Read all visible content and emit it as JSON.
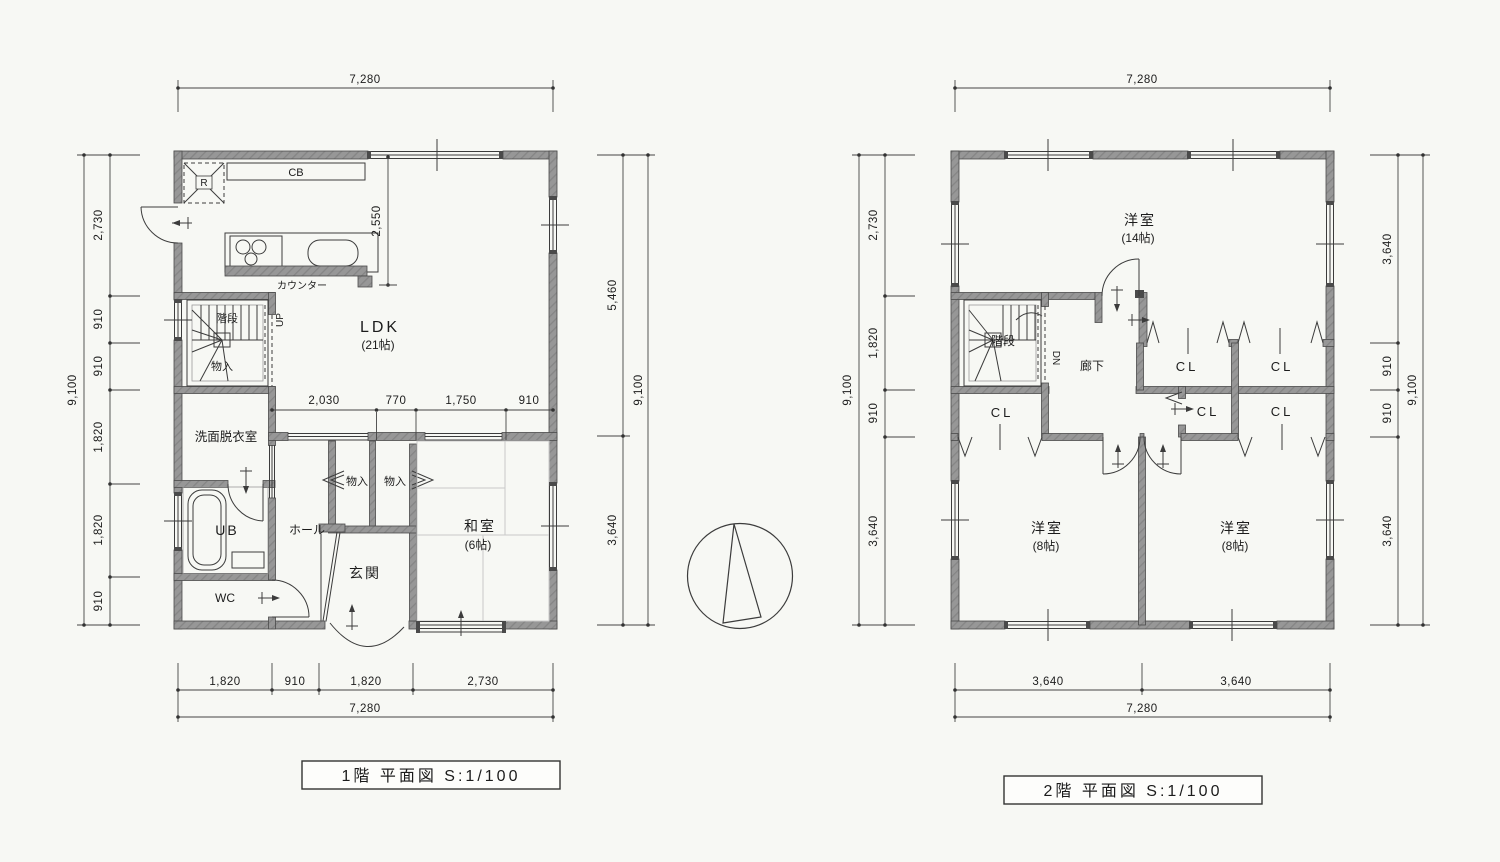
{
  "colors": {
    "background": "#f7f8f4",
    "wall": "#979797",
    "line": "#3c3c3c",
    "dimension": "#444444",
    "tatami": "#c9c9c9"
  },
  "floor1": {
    "title": "1階  平面図 S:1/100",
    "labels": {
      "ldk": "LDK",
      "ldk_size": "(21帖)",
      "washitsu": "和室",
      "washitsu_size": "(6帖)",
      "genkan": "玄関",
      "hall": "ホール",
      "wc": "WC",
      "ub": "UB",
      "senmen": "洗面脱衣室",
      "stairs": "階段",
      "stair_storage": "物入",
      "closet_left": "物入",
      "closet_right": "物入",
      "counter": "カウンター",
      "cb": "CB",
      "fridge": "R",
      "up": "UP"
    },
    "dims": {
      "top_total": "7,280",
      "left_total": "9,100",
      "left": [
        "2,730",
        "910",
        "910",
        "1,820",
        "1,820",
        "910"
      ],
      "right": [
        "5,460",
        "3,640"
      ],
      "right_total": "9,100",
      "inner": [
        "2,030",
        "770",
        "1,750",
        "910"
      ],
      "kitchen_depth": "2,550",
      "bottom": [
        "1,820",
        "910",
        "1,820",
        "2,730"
      ],
      "bottom_total": "7,280"
    }
  },
  "floor2": {
    "title": "2階  平面図 S:1/100",
    "labels": {
      "room14": "洋室",
      "room14_size": "(14帖)",
      "room8_left": "洋室",
      "room8_left_size": "(8帖)",
      "room8_right": "洋室",
      "room8_right_size": "(8帖)",
      "hallway": "廊下",
      "stairs": "階段",
      "dn": "DN",
      "cl_west": "CL",
      "cl_upper_left": "CL",
      "cl_upper_right": "CL",
      "cl_lower_left": "CL",
      "cl_lower_right": "CL"
    },
    "dims": {
      "top_total": "7,280",
      "left_total": "9,100",
      "left": [
        "2,730",
        "1,820",
        "910",
        "3,640"
      ],
      "right": [
        "3,640",
        "910",
        "910",
        "3,640"
      ],
      "right_total": "9,100",
      "bottom": [
        "3,640",
        "3,640"
      ],
      "bottom_total": "7,280"
    }
  }
}
